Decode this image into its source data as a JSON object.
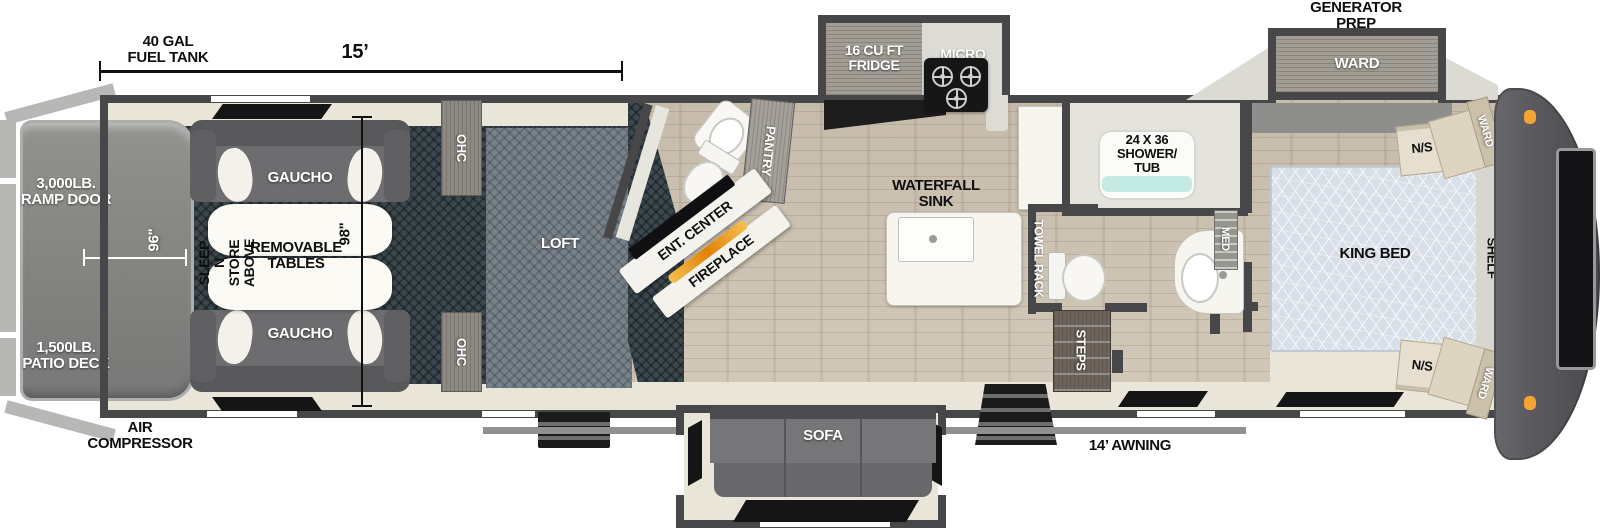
{
  "dims": {
    "fuel_tank": "40 GAL\nFUEL TANK",
    "garage_length": "15’",
    "deck_width": "96\"",
    "garage_width": "98\"",
    "awning": "14’ AWNING"
  },
  "exterior": {
    "generator_prep": "GENERATOR\nPREP",
    "ramp_door": "3,000LB.\nRAMP DOOR",
    "patio_deck": "1,500LB.\nPATIO DECK",
    "air_compressor": "AIR\nCOMPRESSOR"
  },
  "garage": {
    "gaucho_top": "GAUCHO",
    "gaucho_bottom": "GAUCHO",
    "removable_tables": "REMOVABLE\nTABLES",
    "sleep_n_store": "SLEEP N STORE\nABOVE",
    "ohc_top": "OHC",
    "ohc_bottom": "OHC",
    "loft": "LOFT"
  },
  "living": {
    "ent_center": "ENT. CENTER",
    "fireplace": "FIREPLACE",
    "pantry": "PANTRY",
    "sofa": "SOFA"
  },
  "kitchen": {
    "fridge": "16 CU FT\nFRIDGE",
    "micro": "MICRO",
    "waterfall_sink": "WATERFALL\nSINK"
  },
  "bath": {
    "shower_tub": "24 X 36\nSHOWER/\nTUB",
    "towel_rack": "TOWEL RACK",
    "steps": "STEPS",
    "med": "MED"
  },
  "bedroom": {
    "king_bed": "KING BED",
    "ward_slide": "WARD",
    "ward_front_top": "WARD",
    "ward_front_bottom": "WARD",
    "ns_top": "N/S",
    "ns_bottom": "N/S",
    "shelf": "SHELF"
  },
  "colors": {
    "wall": "#47474a",
    "wood_floor": "#cdc3b2",
    "garage_floor": "#3b484d",
    "cream_floor": "#e9e6d9",
    "fireplace_orange": "#e8940f",
    "shower_teal": "#c3ebe3",
    "front_cap": "#4f4f52",
    "marker_light": "#f2a435"
  }
}
